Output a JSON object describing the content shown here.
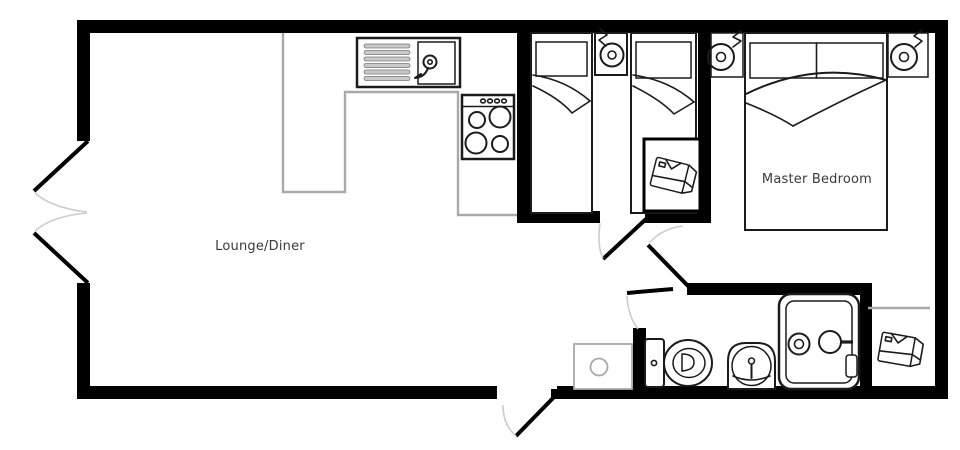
{
  "labels": {
    "lounge_diner": "Lounge/Diner",
    "master_bedroom": "Master Bedroom"
  },
  "colors": {
    "wall": "#000000",
    "furniture_outline": "#1b1b1b",
    "counter_gray": "#a9a9a9",
    "door_arc": "#cccccc",
    "label_text": "#3a3a3a",
    "background": "#ffffff",
    "drainer_fill": "#c9c9c9"
  },
  "icons": [
    "kitchen-sink-icon",
    "hob-icon",
    "single-bed-icon",
    "double-bed-icon",
    "bedside-lamp-icon",
    "wardrobe-shirt-icon",
    "toilet-icon",
    "pedestal-basin-icon",
    "shower-icon",
    "vanity-unit-icon",
    "door-swing-arc"
  ]
}
